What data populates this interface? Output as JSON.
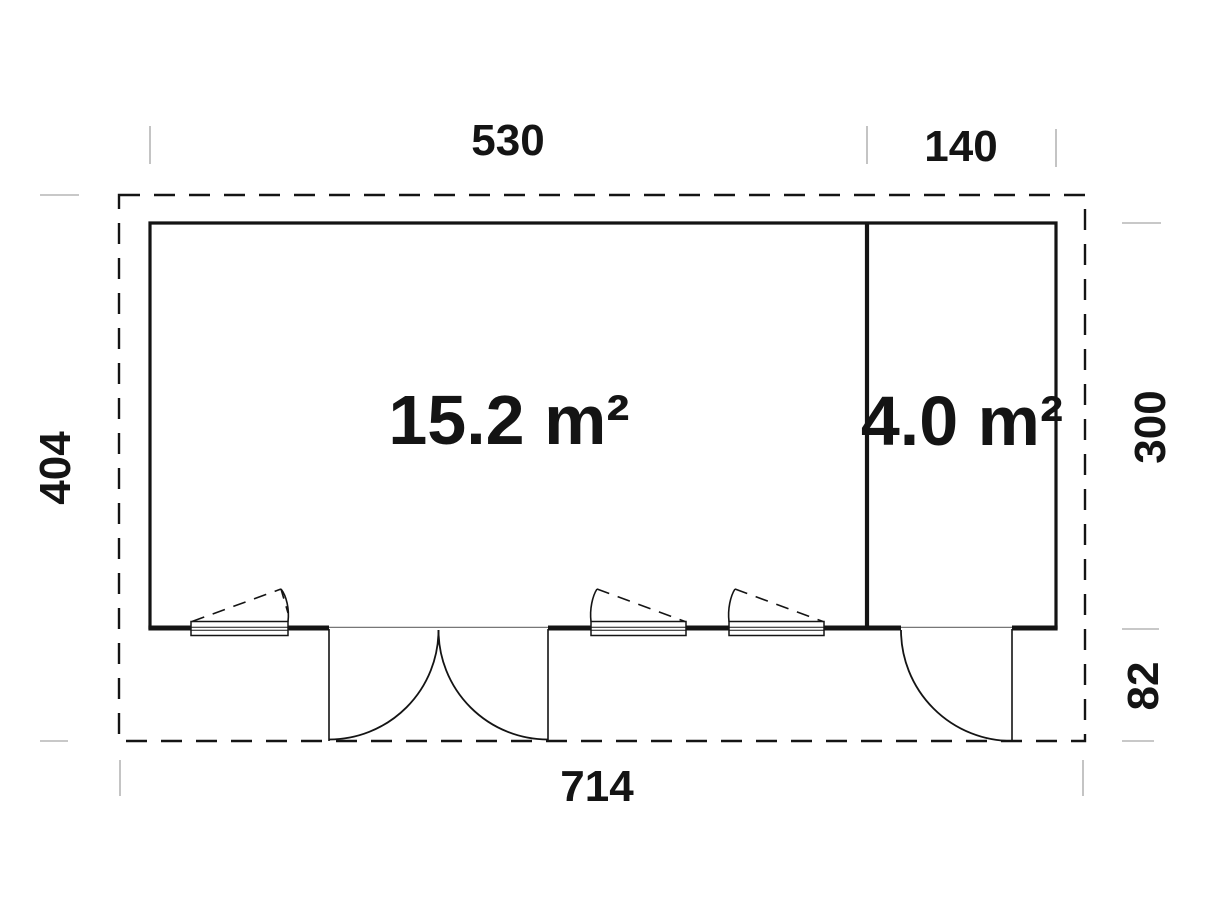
{
  "plan": {
    "colors": {
      "line": "#141414",
      "tick": "#b5b5b5",
      "threshold": "#777777",
      "background": "#ffffff"
    },
    "rooms": [
      {
        "name": "main-room",
        "area_label": "15.2 m²"
      },
      {
        "name": "side-room",
        "area_label": "4.0 m²"
      }
    ],
    "dimensions": {
      "top_left": "530",
      "top_right": "140",
      "left": "404",
      "right_upper": "300",
      "right_lower": "82",
      "bottom": "714"
    }
  }
}
